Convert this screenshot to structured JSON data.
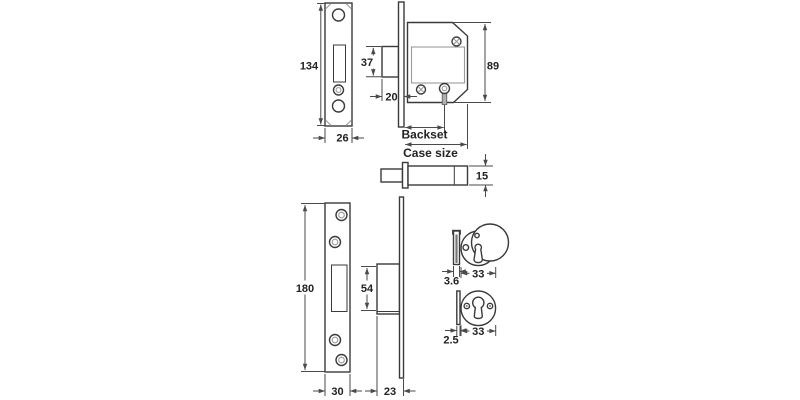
{
  "drawing": {
    "type": "technical-dimension-drawing",
    "subject": "mortice-deadlock-lock-set",
    "background": "#ffffff",
    "line_color": "#3a3a3a",
    "dim_color": "#4a4a4a",
    "text_color": "#222222",
    "labels": {
      "strike_height": "134",
      "strike_width": "26",
      "bolt_height": "37",
      "bolt_throw": "20",
      "case_height": "89",
      "backset": "Backset",
      "case_size": "Case size",
      "bolt_thickness": "15",
      "faceplate_height": "180",
      "faceplate_width": "30",
      "bolt_block_height": "54",
      "bolt_block_depth": "23",
      "escutcheon_covered_thickness": "3.6",
      "escutcheon_covered_diameter": "33",
      "escutcheon_open_thickness": "2.5",
      "escutcheon_open_diameter": "33"
    }
  }
}
